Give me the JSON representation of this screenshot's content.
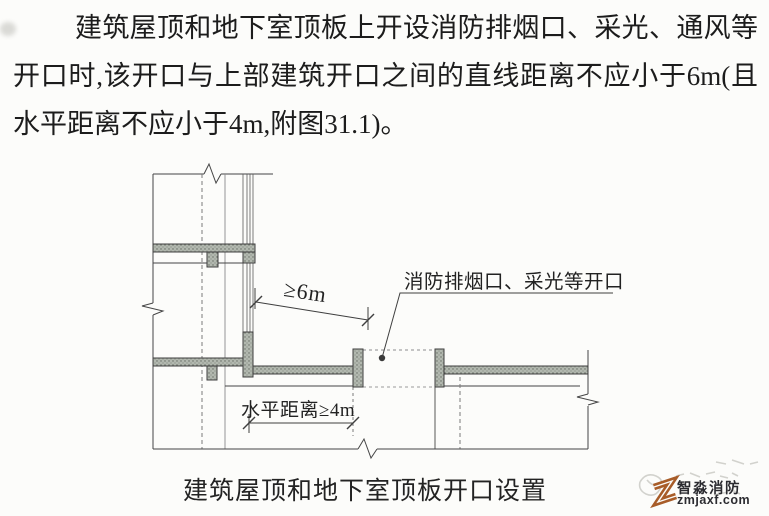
{
  "paragraph": {
    "line1": "建筑屋顶和地下室顶板上开设消防排烟口、采光、通风等",
    "line2": "开口时,该开口与上部建筑开口之间的直线距离不应小于6m(且",
    "line3": "水平距离不应小于4m,附图31.1)。"
  },
  "figure": {
    "dim_straight_line": "≥6m",
    "dim_horizontal": "水平距离≥4m",
    "opening_label": "消防排烟口、采光等开口",
    "caption": "建筑屋顶和地下室顶板开口设置",
    "slab_fill_color": "#b2b8af",
    "slab_dot_color": "#646a62",
    "line_color": "#454545"
  },
  "watermark": {
    "brand": "智淼消防",
    "site": "zmjaxf.com",
    "logo_color": "#a85c28",
    "text_color": "#2c2c31"
  }
}
